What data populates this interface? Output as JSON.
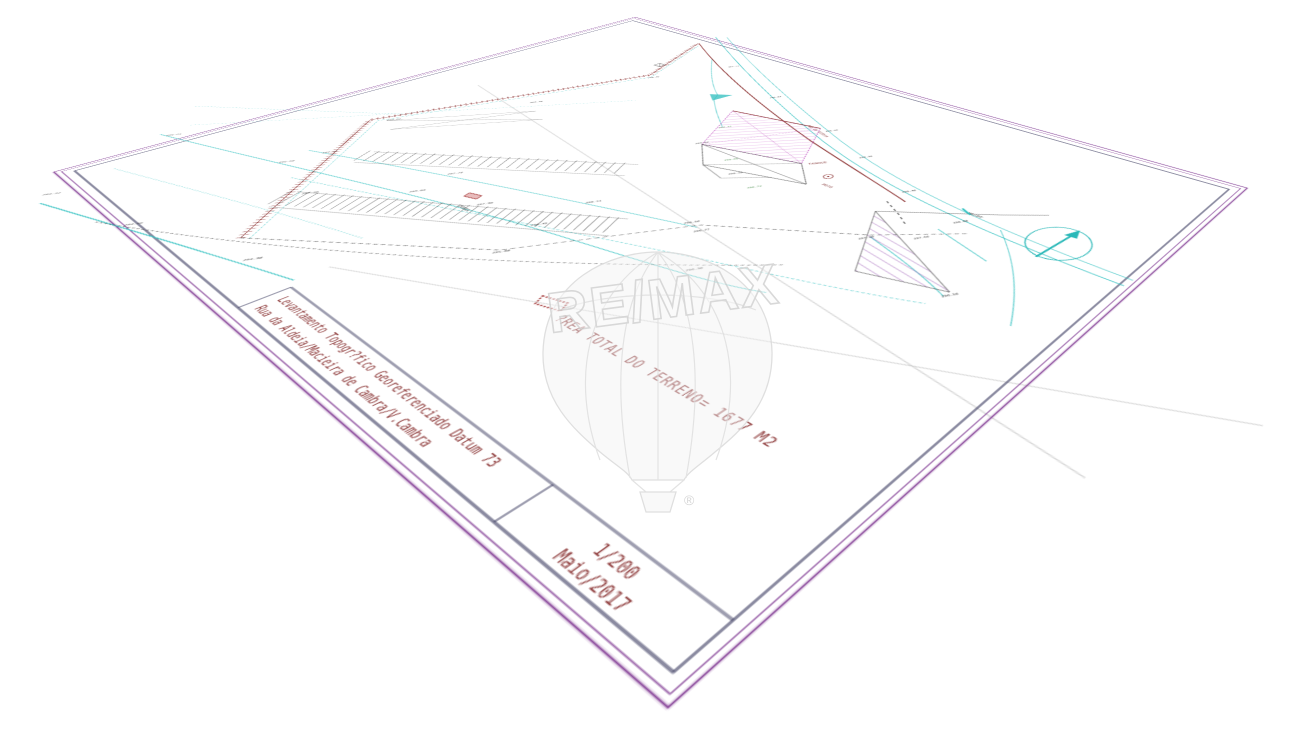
{
  "title_block": {
    "type_label": "Levantamento Topogr?fico Georeferenciado Datum 73",
    "location_label": "Rua da Aldeia/Macieira de Cambra/V.Cambra",
    "scale_label": "1/200",
    "date_label": "Maio/2017"
  },
  "annotations": {
    "area_total": "?REA TOTAL DO TERRENO= 1677 M2",
    "road": "Rua da Aldeia",
    "fossa": "FOSSA",
    "poco": "PO?O",
    "tanque": "TANQUE",
    "mt_pt": "MT/PT"
  },
  "watermark": {
    "brand": "RE/MAX",
    "registered": "®"
  },
  "colors": {
    "frame_purple": "#8b4a9c",
    "frame_navy": "#3f3f63",
    "title_maroon": "#8e3b3b",
    "survey_cyan": "#35c2c2",
    "wall_red": "#8b3030",
    "building_magenta": "#cc5fcc",
    "hatch_violet": "#9b59b6",
    "elevation_green": "#2e7d32",
    "faint_gray": "#bdbdbd"
  },
  "spot_elevations": [
    {
      "t": "294.12",
      "x": 60,
      "y": 722
    },
    {
      "t": "294.56",
      "x": 200,
      "y": 695
    },
    {
      "t": "294.98",
      "x": 360,
      "y": 655
    },
    {
      "t": "295.21",
      "x": -20,
      "y": 598
    },
    {
      "t": "295.60",
      "x": 160,
      "y": 553
    },
    {
      "t": "296.04",
      "x": 340,
      "y": 505
    },
    {
      "t": "296.45",
      "x": 500,
      "y": 472
    },
    {
      "t": "296.90",
      "x": 680,
      "y": 438
    },
    {
      "t": "297.32",
      "x": 170,
      "y": 515
    },
    {
      "t": "297.75",
      "x": 330,
      "y": 462
    },
    {
      "t": "298.11",
      "x": 500,
      "y": 415
    },
    {
      "t": "298.50",
      "x": 610,
      "y": 385
    },
    {
      "t": "297.10",
      "x": 260,
      "y": 570
    },
    {
      "t": "297.90",
      "x": 420,
      "y": 480
    },
    {
      "t": "299.02",
      "x": 130,
      "y": 430
    },
    {
      "t": "300.45",
      "x": 250,
      "y": 160
    },
    {
      "t": "299.78",
      "x": 210,
      "y": 300
    },
    {
      "t": "301.12",
      "x": 300,
      "y": 70
    },
    {
      "t": "300.87",
      "x": 430,
      "y": 115
    },
    {
      "t": "300.40",
      "x": 560,
      "y": 150
    },
    {
      "t": "299.95",
      "x": 640,
      "y": 180
    },
    {
      "t": "299.40",
      "x": 730,
      "y": 215
    },
    {
      "t": "298.88",
      "x": 810,
      "y": 235
    },
    {
      "t": "297.66",
      "x": 800,
      "y": 280
    },
    {
      "t": "297.20",
      "x": 760,
      "y": 310
    },
    {
      "t": "296.50",
      "x": 880,
      "y": 340
    },
    {
      "t": "299.62",
      "x": 470,
      "y": 260
    },
    {
      "t": "299.15",
      "x": 560,
      "y": 290
    },
    {
      "t": "295.88",
      "x": 520,
      "y": 520
    },
    {
      "t": "296.77",
      "x": 630,
      "y": 390
    }
  ],
  "green_elevations": [
    {
      "t": "299.31",
      "x": 455,
      "y": 215
    },
    {
      "t": "299.05",
      "x": 530,
      "y": 270
    },
    {
      "t": "298.72",
      "x": 600,
      "y": 300
    }
  ]
}
